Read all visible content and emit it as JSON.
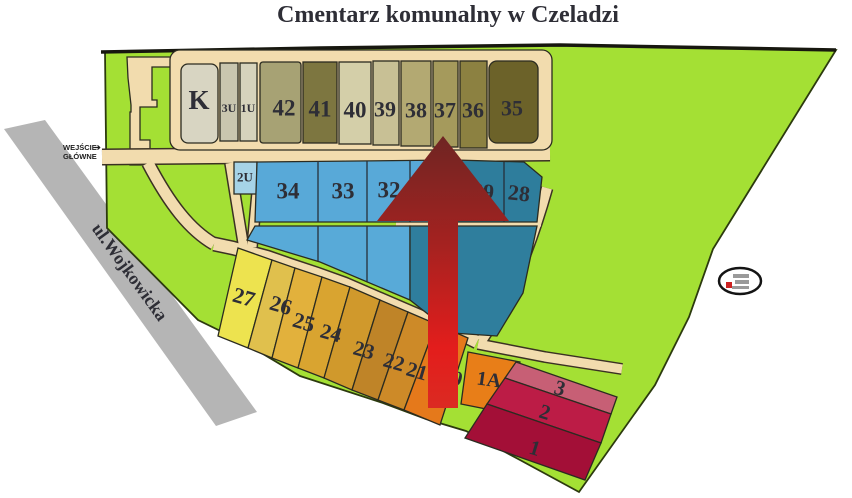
{
  "title": "Cmentarz komunalny w Czeladzi",
  "street": {
    "name": "ul.Wojkowicka"
  },
  "entrance": {
    "line1": "WEJŚCIE",
    "line2": "GŁÓWNE",
    "arrow_glyph": "➔"
  },
  "colors": {
    "green": "#a4e034",
    "road": "#b5b5b5",
    "path": "#f2dcae",
    "block": "#f2dcae",
    "light_blue_lower": "#58aad8",
    "teal_lower": "#2f7e9d"
  },
  "arrow": {
    "top": "#6f2523",
    "mid": "#a52220",
    "bright": "#e31d1c",
    "bottom": "#db2a22"
  },
  "logo": {
    "name": "cemetery-company-logo"
  },
  "plots": {
    "k": {
      "label": "K",
      "color": "#d8d5c2"
    },
    "u3": {
      "label": "3U",
      "color": "#c9c6af"
    },
    "u1": {
      "label": "1U",
      "color": "#d6d3bc"
    },
    "p42": {
      "label": "42",
      "color": "#a7a274"
    },
    "p41": {
      "label": "41",
      "color": "#7d7640"
    },
    "p40": {
      "label": "40",
      "color": "#d4cfa9"
    },
    "p39": {
      "label": "39",
      "color": "#c8c095"
    },
    "p38": {
      "label": "38",
      "color": "#b3a972"
    },
    "p37": {
      "label": "37",
      "color": "#a59a5c"
    },
    "p36": {
      "label": "36",
      "color": "#8c8141"
    },
    "p35": {
      "label": "35",
      "color": "#6c6229"
    },
    "u2": {
      "label": "2U",
      "color": "#a6d3e7"
    },
    "p34": {
      "label": "34",
      "color": "#5cacda"
    },
    "p33": {
      "label": "33",
      "color": "#58a9d8"
    },
    "p32": {
      "label": "32",
      "color": "#55a7d6"
    },
    "p29": {
      "label": "29",
      "color": "#30809f"
    },
    "p28": {
      "label": "28",
      "color": "#2e7d9c"
    },
    "p27": {
      "label": "27",
      "color": "#ede34f"
    },
    "p26": {
      "label": "26",
      "color": "#e0c04d"
    },
    "p25": {
      "label": "25",
      "color": "#e2b13c"
    },
    "p24": {
      "label": "24",
      "color": "#d9a430"
    },
    "p23": {
      "label": "23",
      "color": "#d0992c"
    },
    "p22": {
      "label": "22",
      "color": "#bf8428"
    },
    "p21": {
      "label": "21",
      "color": "#cd8a28"
    },
    "p20": {
      "label": "20",
      "color": "#e5791b"
    },
    "p1a": {
      "label": "1A",
      "color": "#e87e18"
    },
    "s3": {
      "label": "3",
      "color": "#c75f75"
    },
    "s2": {
      "label": "2",
      "color": "#bc1c46"
    },
    "s1": {
      "label": "1",
      "color": "#a30f37"
    }
  }
}
